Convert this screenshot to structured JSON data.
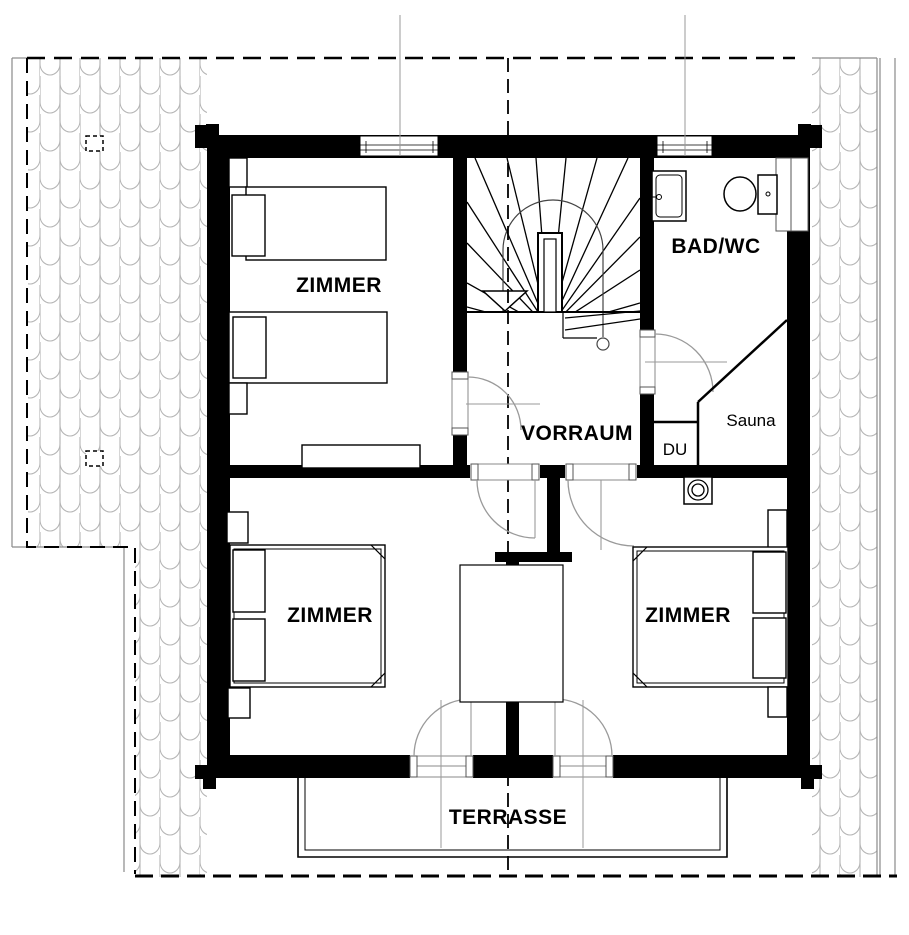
{
  "plan": {
    "rooms": {
      "zimmer_top_left": {
        "label": "ZIMMER"
      },
      "zimmer_bottom_left": {
        "label": "ZIMMER"
      },
      "zimmer_bottom_right": {
        "label": "ZIMMER"
      },
      "vorraum": {
        "label": "VORRAUM"
      },
      "bad_wc": {
        "label": "BAD/WC"
      },
      "du": {
        "label": "DU"
      },
      "sauna": {
        "label": "Sauna"
      },
      "terrasse": {
        "label": "TERRASSE"
      }
    },
    "colors": {
      "wall": "#000000",
      "background": "#ffffff",
      "roof_hatch": "#b5b5b5",
      "door_swing": "#9a9a9a",
      "reference_line": "#999999",
      "axis_dash": "#000000"
    }
  }
}
